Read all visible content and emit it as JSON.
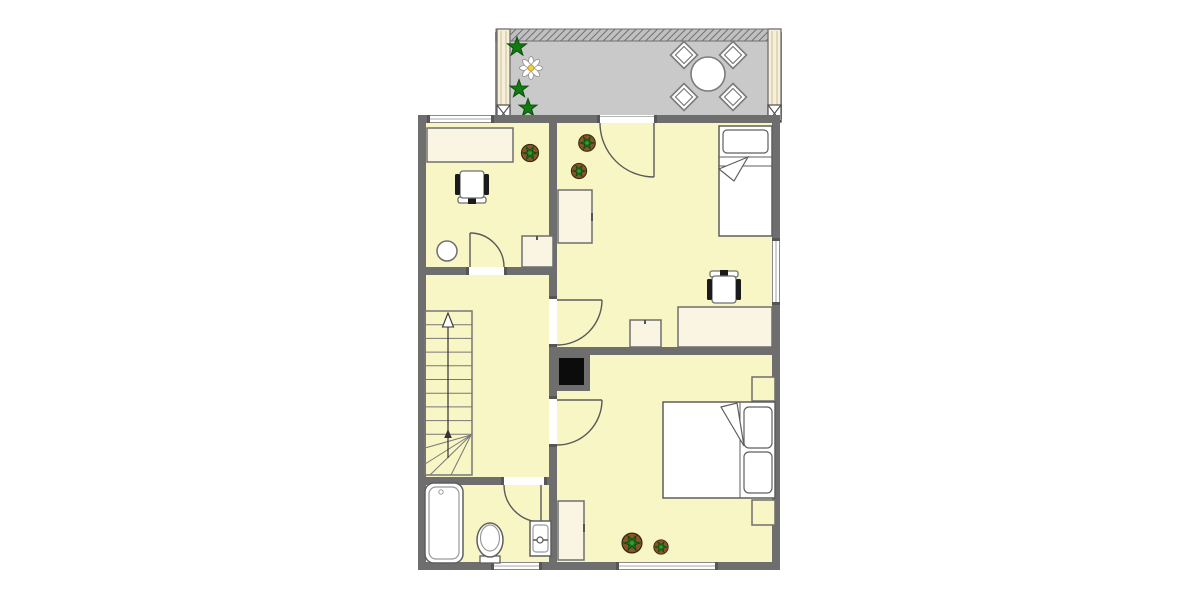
{
  "canvas": {
    "width": 1200,
    "height": 600
  },
  "palette": {
    "background": "#ffffff",
    "floor": "#f9f6c5",
    "wall": "#6e6e6e",
    "balcony_floor": "#c9c9c9",
    "railing_base": "#c0c0c0",
    "railing_hatch": "#707070",
    "post": "#f6f0da",
    "post_line": "#c9bd96",
    "furniture_cream": "#f9f5e2",
    "furniture_white": "#ffffff",
    "furniture_outline": "#5f5f5f",
    "fixture_inner": "#9a9a9a",
    "window_frame": "#8a8a8a",
    "jamb": "#565656",
    "door_line": "#5a5a5a",
    "stair_line": "#777777",
    "arrow": "#333333",
    "plant_leaf": "#1b6e1b",
    "plant_leaf_light": "#2fa12f",
    "plant_pot": "#8a5429",
    "star_green": "#117a11",
    "daisy_petal": "#ffffff",
    "daisy_center": "#eccf45",
    "chimney": "#0c0c0c",
    "chair_arm": "#1a1a1a"
  },
  "areas": {
    "balcony": {
      "kind": "terrace",
      "items": [
        {
          "item": "hatched-railing",
          "count": 1
        },
        {
          "item": "corner-post-with-x-brace",
          "count": 2
        },
        {
          "item": "round-table",
          "count": 1
        },
        {
          "item": "diamond-chair",
          "count": 4
        },
        {
          "item": "green-star-plant",
          "count": 3
        },
        {
          "item": "daisy-flower",
          "count": 1
        }
      ]
    },
    "room_top_left": {
      "kind": "study",
      "items": [
        {
          "item": "window-top-wall",
          "count": 1
        },
        {
          "item": "desk",
          "count": 1
        },
        {
          "item": "office-chair",
          "count": 1
        },
        {
          "item": "potted-plant",
          "count": 1
        },
        {
          "item": "round-stool",
          "count": 1
        },
        {
          "item": "side-table",
          "count": 1
        },
        {
          "item": "door-to-hallway",
          "count": 1
        }
      ]
    },
    "room_top_right": {
      "kind": "bedroom-single",
      "items": [
        {
          "item": "balcony-door",
          "count": 1
        },
        {
          "item": "single-bed-with-pillow",
          "count": 1
        },
        {
          "item": "wardrobe",
          "count": 1
        },
        {
          "item": "desk",
          "count": 1
        },
        {
          "item": "office-chair",
          "count": 1
        },
        {
          "item": "small-cabinet",
          "count": 1
        },
        {
          "item": "potted-plant",
          "count": 2
        },
        {
          "item": "window-right-wall",
          "count": 1
        },
        {
          "item": "door-to-hallway",
          "count": 1
        }
      ]
    },
    "hallway": {
      "kind": "stair-hall",
      "items": [
        {
          "item": "staircase-with-winder",
          "count": 1
        },
        {
          "item": "up-direction-arrow",
          "count": 1
        },
        {
          "item": "chimney-shaft",
          "count": 1
        }
      ]
    },
    "room_bottom_right": {
      "kind": "bedroom-double",
      "items": [
        {
          "item": "double-bed-two-pillows",
          "count": 1
        },
        {
          "item": "nightstand",
          "count": 2
        },
        {
          "item": "cabinet",
          "count": 1
        },
        {
          "item": "potted-plant",
          "count": 2
        },
        {
          "item": "window-bottom-wall",
          "count": 1
        },
        {
          "item": "door-to-hallway",
          "count": 1
        }
      ]
    },
    "bathroom": {
      "kind": "bathroom",
      "items": [
        {
          "item": "bathtub",
          "count": 1
        },
        {
          "item": "toilet",
          "count": 1
        },
        {
          "item": "sink-with-faucet",
          "count": 1
        },
        {
          "item": "window-bottom-wall",
          "count": 1
        },
        {
          "item": "door-to-hallway",
          "count": 1
        }
      ]
    }
  }
}
